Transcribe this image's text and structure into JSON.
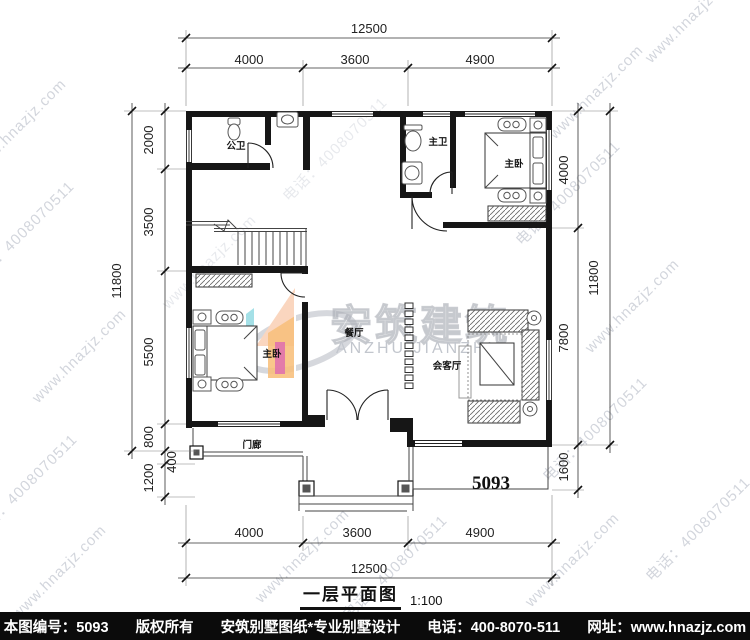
{
  "watermark": {
    "url": "www.hnazjz.com",
    "phone": "电话：4008070511"
  },
  "logo": {
    "cn": "安筑建筑",
    "en": "ANZHU JIANZHU"
  },
  "rooms": {
    "public_bath": "公卫",
    "master_bath": "主卫",
    "master_bed_right": "主卧",
    "master_bed_left": "主卧",
    "dining": "餐厅",
    "reception": "会客厅",
    "porch": "门廊"
  },
  "plan_number": "5093",
  "dims": {
    "top": {
      "overall": "12500",
      "seg1": "4000",
      "seg2": "3600",
      "seg3": "4900"
    },
    "bottom": {
      "overall": "12500",
      "seg1": "4000",
      "seg2": "3600",
      "seg3": "4900"
    },
    "left": {
      "overall": "11800",
      "seg1": "2000",
      "seg2": "3500",
      "seg3": "5500",
      "seg4": "800",
      "seg5": "400",
      "seg6": "1200"
    },
    "right": {
      "overall": "11800",
      "seg1": "4000",
      "seg2": "7800",
      "seg3": "1600"
    }
  },
  "title": {
    "name": "一层平面图",
    "scale": "1:100"
  },
  "footer": {
    "parts": [
      "本图编号：5093",
      "版权所有",
      "安筑别墅图纸*专业别墅设计",
      "电话：400-8070-511",
      "网址：www.hnazjz.com"
    ]
  }
}
